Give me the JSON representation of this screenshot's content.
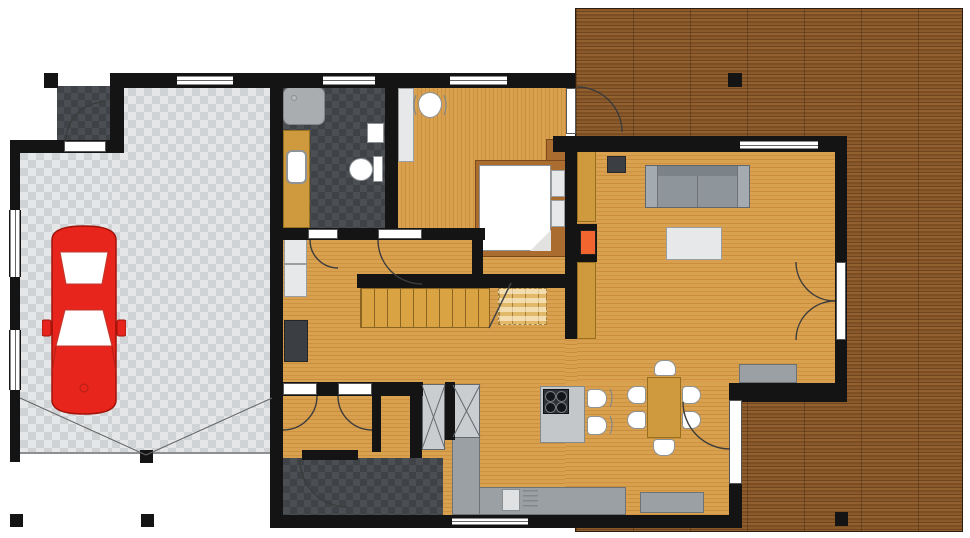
{
  "drawing": {
    "kind": "residential-floor-plan-top-view",
    "rooms": [
      {
        "name": "garage",
        "floor": "light-checker-tile"
      },
      {
        "name": "entry-porch",
        "floor": "dark-checker-tile"
      },
      {
        "name": "bathroom",
        "floor": "dark-checker-tile"
      },
      {
        "name": "bedroom",
        "floor": "wood"
      },
      {
        "name": "hallway",
        "floor": "wood"
      },
      {
        "name": "staircase",
        "floor": "wood-treads"
      },
      {
        "name": "living-room",
        "floor": "wood"
      },
      {
        "name": "kitchen",
        "floor": "wood"
      },
      {
        "name": "dining-area",
        "floor": "wood"
      },
      {
        "name": "vestibule",
        "floor": "wood"
      },
      {
        "name": "mudroom",
        "floor": "dark-checker-tile"
      },
      {
        "name": "deck",
        "floor": "dark-wood-planks"
      }
    ],
    "furniture": [
      {
        "name": "car",
        "count": 1
      },
      {
        "name": "shower-tray",
        "count": 1
      },
      {
        "name": "washbasin",
        "count": 1
      },
      {
        "name": "toilet",
        "count": 1
      },
      {
        "name": "desk",
        "count": 1
      },
      {
        "name": "desk-chair",
        "count": 1
      },
      {
        "name": "double-bed",
        "count": 1
      },
      {
        "name": "pillow",
        "count": 2
      },
      {
        "name": "nightstand",
        "count": 1
      },
      {
        "name": "sofa",
        "count": 1
      },
      {
        "name": "coffee-table",
        "count": 1
      },
      {
        "name": "media-unit",
        "count": 1
      },
      {
        "name": "fireplace",
        "count": 1
      },
      {
        "name": "wall-counter",
        "count": 2
      },
      {
        "name": "kitchen-island-with-cooktop",
        "count": 1
      },
      {
        "name": "bar-stool",
        "count": 2
      },
      {
        "name": "kitchen-counter-with-sink",
        "count": 1
      },
      {
        "name": "wardrobe-crossed",
        "count": 2
      },
      {
        "name": "dining-table",
        "count": 1
      },
      {
        "name": "dining-chair",
        "count": 6
      },
      {
        "name": "bench",
        "count": 2
      },
      {
        "name": "storage-cabinet",
        "count": 3
      },
      {
        "name": "deck-post",
        "count": 2
      }
    ],
    "openings": {
      "windows": 7,
      "swing-doors": 10,
      "french-doors": 1
    }
  },
  "palette": {
    "wall": "#141414",
    "floor_wood": "#d49a4a",
    "deck_wood": "#80522a",
    "stair_wood": "#d9a243",
    "counter_tan": "#cf9a3d",
    "bed_wood": "#aa6c2f",
    "tile_dark_a": "#4b4e52",
    "tile_dark_b": "#3f4246",
    "garage_sq_a": "#e4e6e8",
    "garage_sq_b": "#d0d3d5",
    "fireplace_orange": "#f2652e",
    "car_red": "#e8251d",
    "sofa_gray": "#8f969b",
    "counter_gray": "#9aa0a4",
    "cabinet_dark": "#3b3f43"
  }
}
